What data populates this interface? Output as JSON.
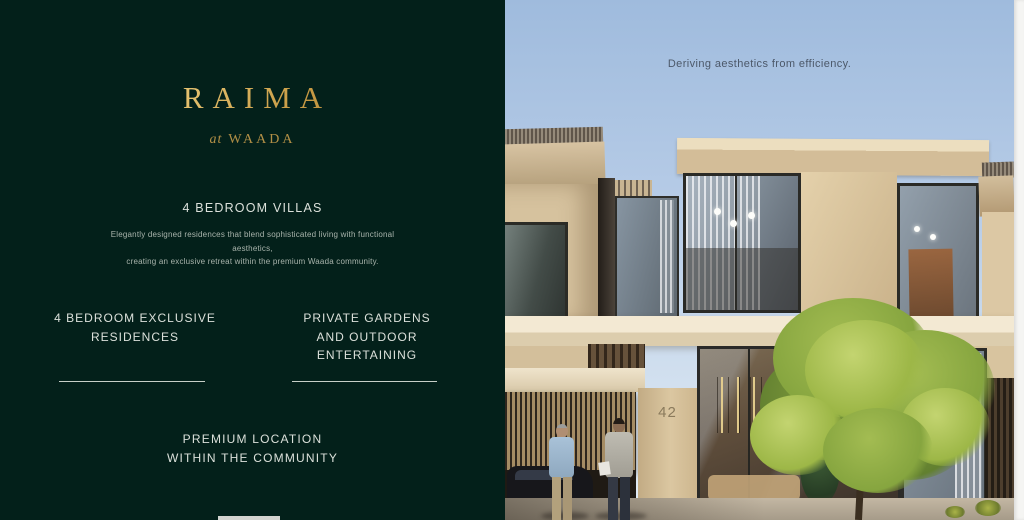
{
  "brand_panel": {
    "logo": {
      "title": "RAIMA",
      "subtitle_prefix": "at",
      "subtitle_brand": "WAADA"
    },
    "headline": "4 BEDROOM VILLAS",
    "description": "Elegantly designed residences that blend sophisticated living with functional aesthetics,\ncreating an exclusive retreat within the premium Waada community.",
    "features": [
      {
        "label": "4 BEDROOM EXCLUSIVE\nRESIDENCES"
      },
      {
        "label": "PRIVATE GARDENS\nAND OUTDOOR\nENTERTAINING"
      },
      {
        "label": "PREMIUM LOCATION\nWITHIN THE COMMUNITY"
      }
    ],
    "colors": {
      "background": "#03201a",
      "gold": "#c79a44",
      "text": "#dde2dc"
    }
  },
  "photo": {
    "caption": "Deriving aesthetics from efficiency.",
    "house_number": "42",
    "colors": {
      "sky": "#a9c3e2",
      "wall_beige": "#d8c4a0",
      "foliage_green": "#93af45"
    }
  }
}
